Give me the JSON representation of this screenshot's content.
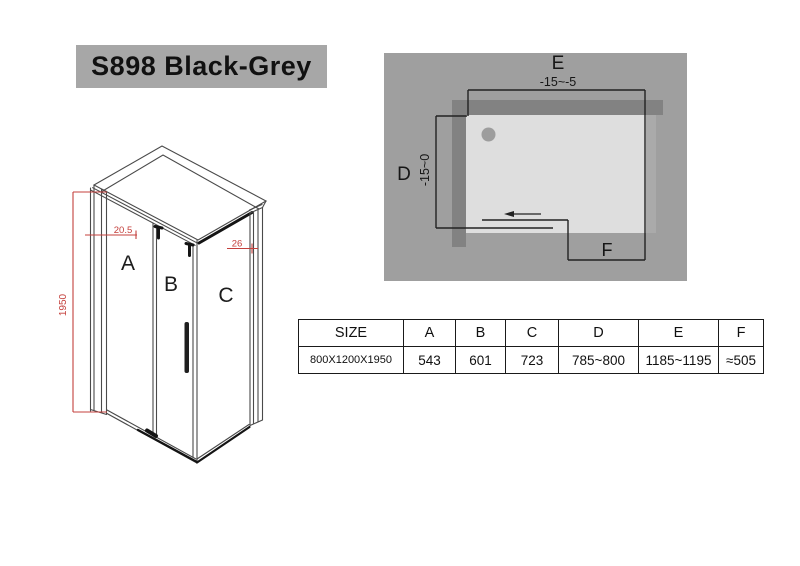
{
  "title": "S898 Black-Grey",
  "iso": {
    "label_a": "A",
    "label_b": "B",
    "label_c": "C",
    "dim_height": "1950",
    "dim_top_a": "20.5",
    "dim_top_c": "26"
  },
  "plan": {
    "label_e": "E",
    "value_e": "-15~-5",
    "label_d": "D",
    "value_d": "-15~0",
    "label_f": "F"
  },
  "table": {
    "headers": [
      "SIZE",
      "A",
      "B",
      "C",
      "D",
      "E",
      "F"
    ],
    "rows": [
      [
        "800X1200X1950",
        "543",
        "601",
        "723",
        "785~800",
        "1185~1195",
        "≈505"
      ]
    ]
  },
  "colors": {
    "banner_bg": "#a7a7a7",
    "plan_bg": "#9f9f9f",
    "wall_strip": "#828282",
    "tray": "#dedede",
    "drain": "#9d9d9d",
    "dim_red": "#c4403c",
    "line_dark": "#141414"
  }
}
